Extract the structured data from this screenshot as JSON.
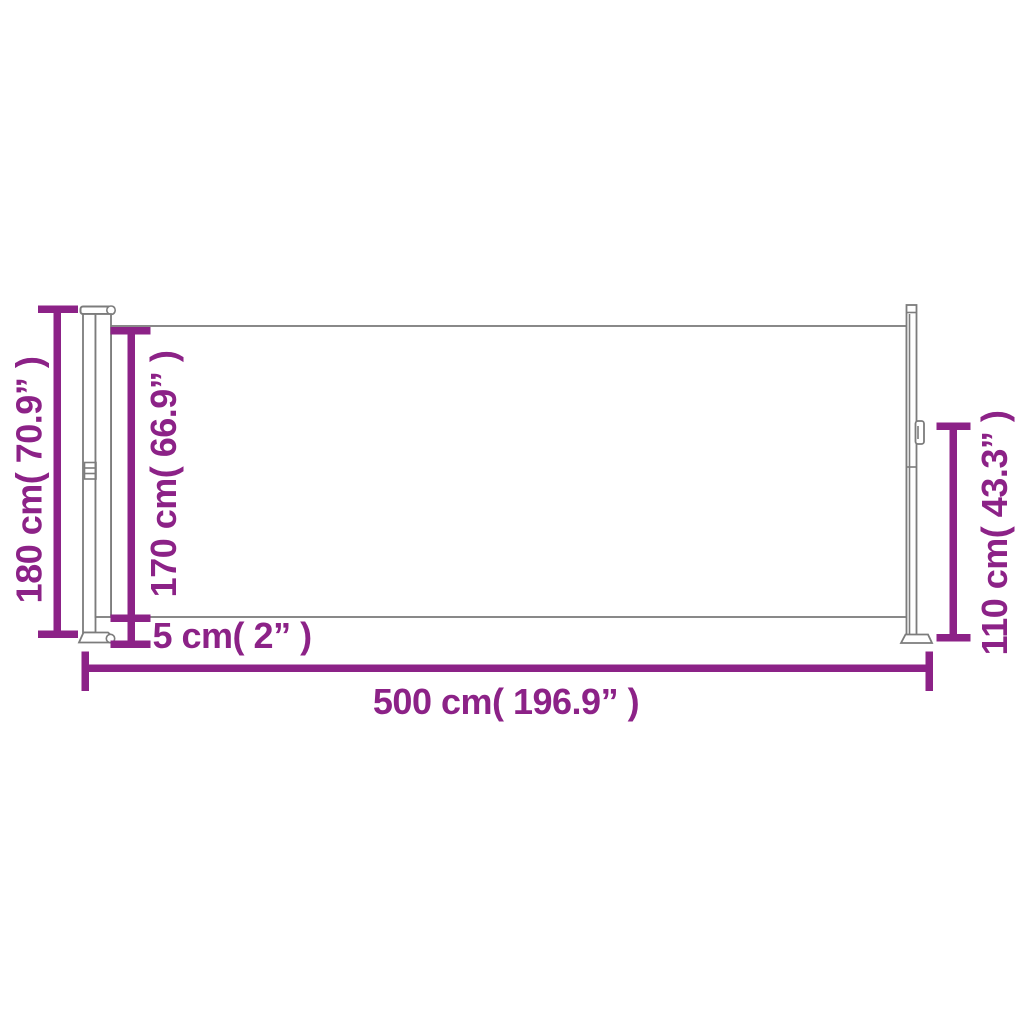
{
  "diagram": {
    "name": "Retractable side awning dimension drawing",
    "background_color": "#FFFFFF",
    "accent_color": "#8C2287",
    "outline_color": "#7C7C7C",
    "labels": {
      "total_height": "180 cm( 70.9” )",
      "fabric_height": "170 cm( 66.9” )",
      "bottom_gap": "5 cm( 2” )",
      "total_width": "500 cm( 196.9” )",
      "post_height": "110 cm( 43.3” )"
    }
  }
}
